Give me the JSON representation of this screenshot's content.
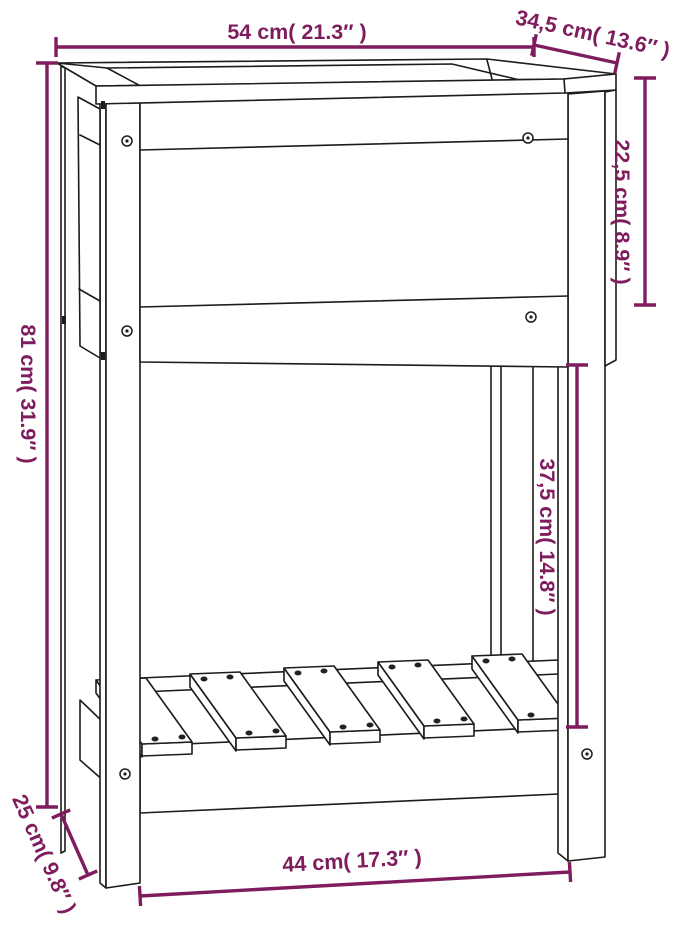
{
  "colors": {
    "dimension_color": "#7E1C5D",
    "outline_color": "#1c1c1c",
    "background": "#ffffff"
  },
  "dimensions": {
    "top_width": {
      "label": "54 cm( 21.3″ )",
      "value_cm": "54",
      "value_in": "21.3"
    },
    "top_depth": {
      "label": "34,5 cm( 13.6″ )",
      "value_cm": "34,5",
      "value_in": "13.6"
    },
    "planter_height": {
      "label": "22,5 cm( 8.9″ )",
      "value_cm": "22,5",
      "value_in": "8.9"
    },
    "total_height": {
      "label": "81 cm( 31.9″ )",
      "value_cm": "81",
      "value_in": "31.9"
    },
    "shelf_clearance": {
      "label": "37,5 cm( 14.8″ )",
      "value_cm": "37,5",
      "value_in": "14.8"
    },
    "shelf_height": {
      "label": "25 cm( 9.8″ )",
      "value_cm": "25",
      "value_in": "9.8"
    },
    "bottom_width": {
      "label": "44 cm( 17.3″ )",
      "value_cm": "44",
      "value_in": "17.3"
    }
  }
}
